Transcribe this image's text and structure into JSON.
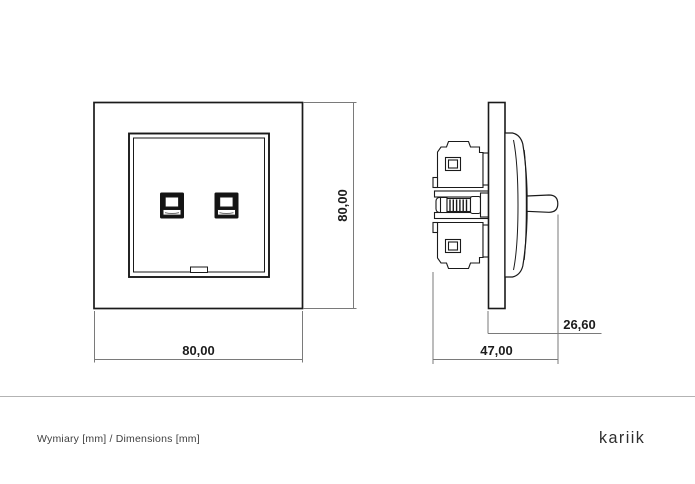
{
  "drawing": {
    "title": "wall socket dimension drawing",
    "front_view": {
      "name": "front-view",
      "width_dim": "80,00",
      "height_dim": "80,00"
    },
    "side_view": {
      "name": "side-view",
      "depth_dim": "47,00",
      "protrusion_dim": "26,60"
    }
  },
  "footer": {
    "note": "Wymiary [mm] / Dimensions [mm]",
    "brand": "kariik"
  },
  "colors": {
    "line": "#1a1a1a",
    "dimension_line": "#7a7a7a",
    "jack_fill": "#141414",
    "divider": "#b3b3b3",
    "footer_text": "#3f3f3f",
    "background": "#ffffff"
  }
}
